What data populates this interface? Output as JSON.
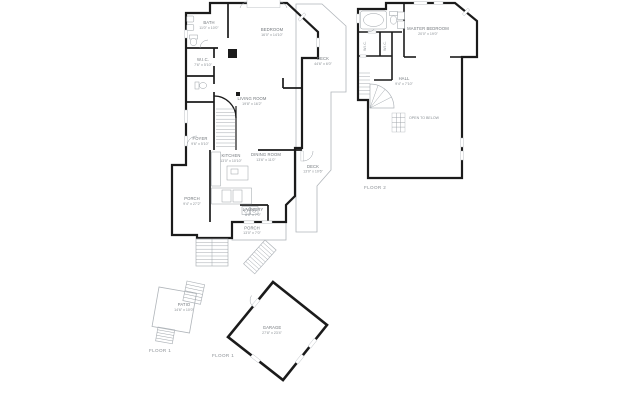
{
  "colors": {
    "floor_fill": "#e9ecef",
    "wall": "#1b1b1b",
    "thin_line": "#b0b5ba",
    "label_text": "#71767b",
    "dim_text": "#8a9095"
  },
  "floor1": {
    "caption": "FLOOR 1",
    "rooms": {
      "bath": {
        "name": "BATH",
        "dims": "11'0\" x 10'0\""
      },
      "bedroom": {
        "name": "BEDROOM",
        "dims": "16'0\" x 14'10\""
      },
      "deck_right": {
        "name": "DECK",
        "dims": "44'6\" x 6'0\""
      },
      "wic": {
        "name": "W.I.C.",
        "dims": "7'6\" x 5'10\""
      },
      "living": {
        "name": "LIVING ROOM",
        "dims": "19'8\" x 16'2\""
      },
      "foyer": {
        "name": "FOYER",
        "dims": "9'6\" x 5'10\""
      },
      "kitchen": {
        "name": "KITCHEN",
        "dims": "13'0\" x 10'10\""
      },
      "dining": {
        "name": "DINING ROOM",
        "dims": "13'6\" x 11'0\""
      },
      "deck_small": {
        "name": "DECK",
        "dims": "13'0\" x 10'6\""
      },
      "porch_left": {
        "name": "PORCH",
        "dims": "9'4\" x 27'2\""
      },
      "laundry": {
        "name": "LAUNDRY",
        "dims": "8'0\" x 7'0\""
      },
      "porch_bottom": {
        "name": "PORCH",
        "dims": "13'0\" x 7'0\""
      }
    }
  },
  "floor2": {
    "caption": "FLOOR 2",
    "rooms": {
      "master": {
        "name": "MASTER BEDROOM",
        "dims": "20'0\" x 19'0\""
      },
      "wic_a": {
        "name": "W.I.C."
      },
      "wic_b": {
        "name": "W.I.C."
      },
      "hall": {
        "name": "HALL",
        "dims": "9'4\" x 7'10\""
      },
      "open_below": {
        "name": "OPEN TO BELOW"
      }
    }
  },
  "ground": {
    "caption_left": "FLOOR 1",
    "caption_garage": "FLOOR 1",
    "patio": {
      "name": "PATIO",
      "dims": "14'6\" x 10'0\""
    },
    "garage": {
      "name": "GARAGE",
      "dims": "27'8\" x 23'4\""
    }
  }
}
